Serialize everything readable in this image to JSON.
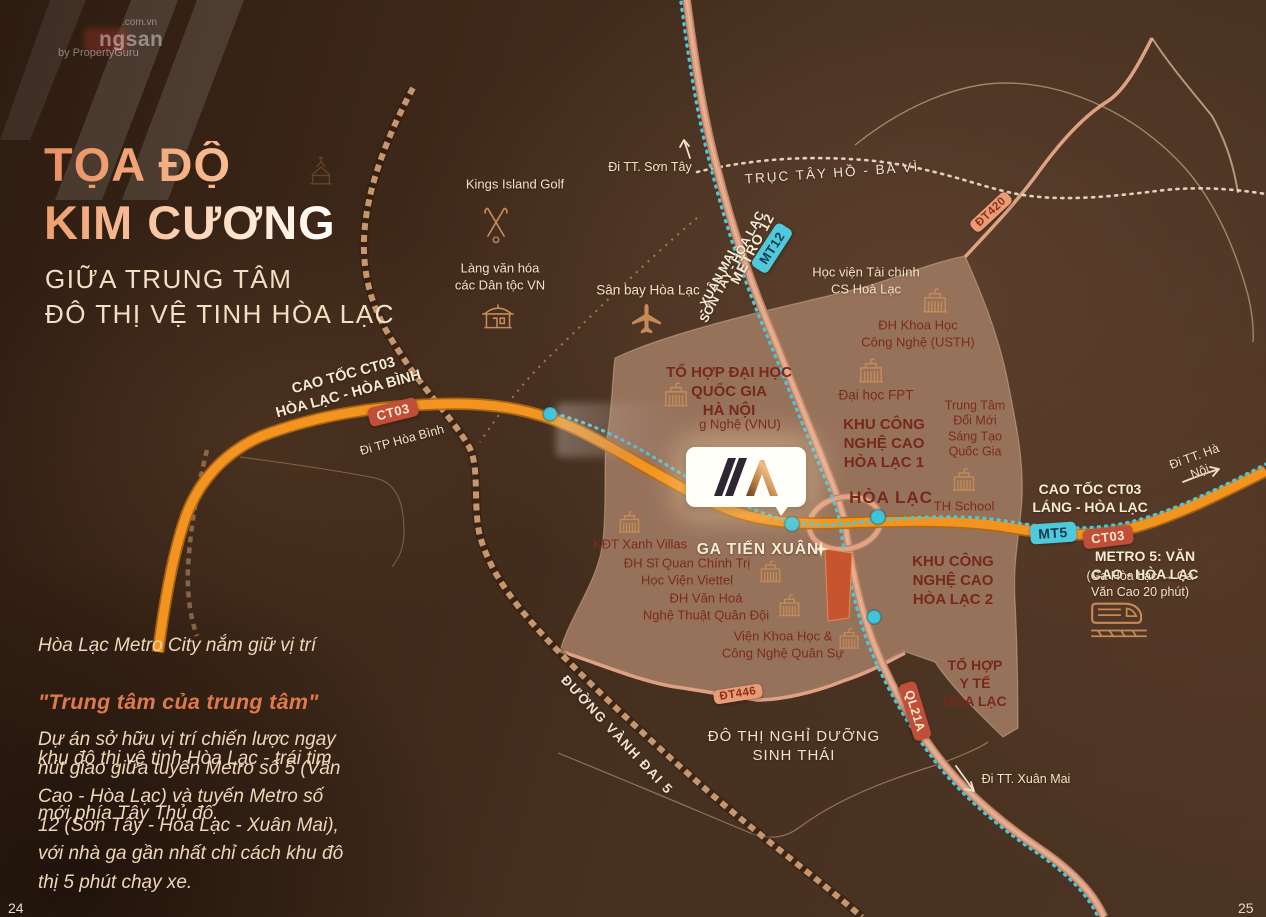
{
  "colors": {
    "accent_orange": "#F2941F",
    "metro_cyan": "#45C6D8",
    "title_peach": "#EF9E6F",
    "highlight_orange": "#E0794B",
    "badge_red": "#C24F3A",
    "zone_brown": "#97725B"
  },
  "watermark": {
    "domain_suffix": ".com.vn",
    "brand_fragment": "ngsan",
    "byline": "by PropertyGuru"
  },
  "panel": {
    "title_line1": "TỌA ĐỘ",
    "title_line2": "KIM CƯƠNG",
    "subtitle_line1": "GIỮA TRUNG TÂM",
    "subtitle_line2": "ĐÔ THỊ VỆ TINH HÒA LẠC",
    "intro": {
      "line1": "Hòa Lạc Metro City nắm giữ vị trí",
      "highlight": "\"Trung tâm của trung tâm\"",
      "line3": "khu đô thị vệ tinh Hòa Lạc  - trái tim",
      "line4": "mới phía Tây Thủ đô."
    },
    "body": "Dự án sở hữu vị trí chiến lược ngay\nnút giao giữa tuyến Metro số 5 (Văn\nCao - Hòa Lạc) và tuyến Metro số\n12 (Sơn Tây - Hòa Lạc - Xuân Mai),\nvới nhà ga gần nhất chỉ cách khu đô\nthị 5 phút chạy xe.",
    "page_left": "24",
    "page_right": "25"
  },
  "map": {
    "roads": {
      "cao_toc_west": "CAO TỐC CT03\nHÒA LẠC - HÒA BÌNH",
      "di_tp_hoa_binh": "Đi TP Hòa Bình",
      "truc_tay_ho": "TRỤC TÂY HỒ - BA VÌ",
      "metro12_line1": "METRO 12",
      "metro12_line2": "SƠN TÂY - HÒA LẠC",
      "metro12_line3": "- XUÂN MAI",
      "vanh_dai_5": "ĐƯỜNG VÀNH ĐAI 5",
      "cao_toc_east": "CAO TỐC CT03\nLÁNG - HÒA LẠC",
      "metro5_title": "METRO 5: VĂN CAO - HÒA LẠC",
      "metro5_sub": "(Ga Hòa Lạc → Ga Văn Cao 20 phút)",
      "di_son_tay": "Đi TT. Sơn Tây",
      "di_ha_noi": "Đi TT. Hà Nội",
      "di_xuan_mai": "Đi TT. Xuân Mai"
    },
    "badges": {
      "mt12": "MT12",
      "dt420": "ĐT420",
      "ct03_west": "CT03",
      "mt5": "MT5",
      "ct03_east": "CT03",
      "dt446": "ĐT446",
      "ql21a": "QL21A"
    },
    "places": {
      "kings_island": "Kings Island Golf",
      "lang_van_hoa": "Làng văn hóa\ncác Dân tộc VN",
      "san_bay": "Sân bay Hòa Lạc",
      "hoc_vien_tai_chinh": "Học viện Tài chính\nCS Hoà Lạc",
      "usth": "ĐH Khoa Học\nCông Nghệ (USTH)",
      "vnu": "TỔ HỢP ĐẠI HỌC\nQUỐC GIA\nHÀ NỘI",
      "vnu_sub": "g Nghệ (VNU)",
      "fpt": "Đại học FPT",
      "kcn1": "KHU CÔNG\nNGHỆ CAO\nHÒA LẠC 1",
      "dmst": "Trung Tâm\nĐổi Mới\nSáng Tạo\nQuốc Gia",
      "hoa_lac": "HÒA LẠC",
      "th_school": "TH School",
      "kdt_xanh_villas": "KĐT Xanh Villas",
      "dh_si_quan": "ĐH Sĩ Quan Chính Trị\nHọc Viện Viettel",
      "ga_tien_xuan": "GA TIẾN XUÂN",
      "dh_van_hoa": "ĐH Văn Hoá\nNghệ Thuật Quân Đội",
      "kcn2": "KHU CÔNG\nNGHỆ CAO\nHÒA LẠC 2",
      "vien_khqs": "Viện Khoa Học &\nCông Nghệ Quân Sự",
      "y_te": "TỔ HỢP\nY TẾ\nHÒA LẠC",
      "do_thi_nghi_duong": "ĐÔ THỊ NGHỈ DƯỠNG\nSINH THÁI"
    }
  }
}
